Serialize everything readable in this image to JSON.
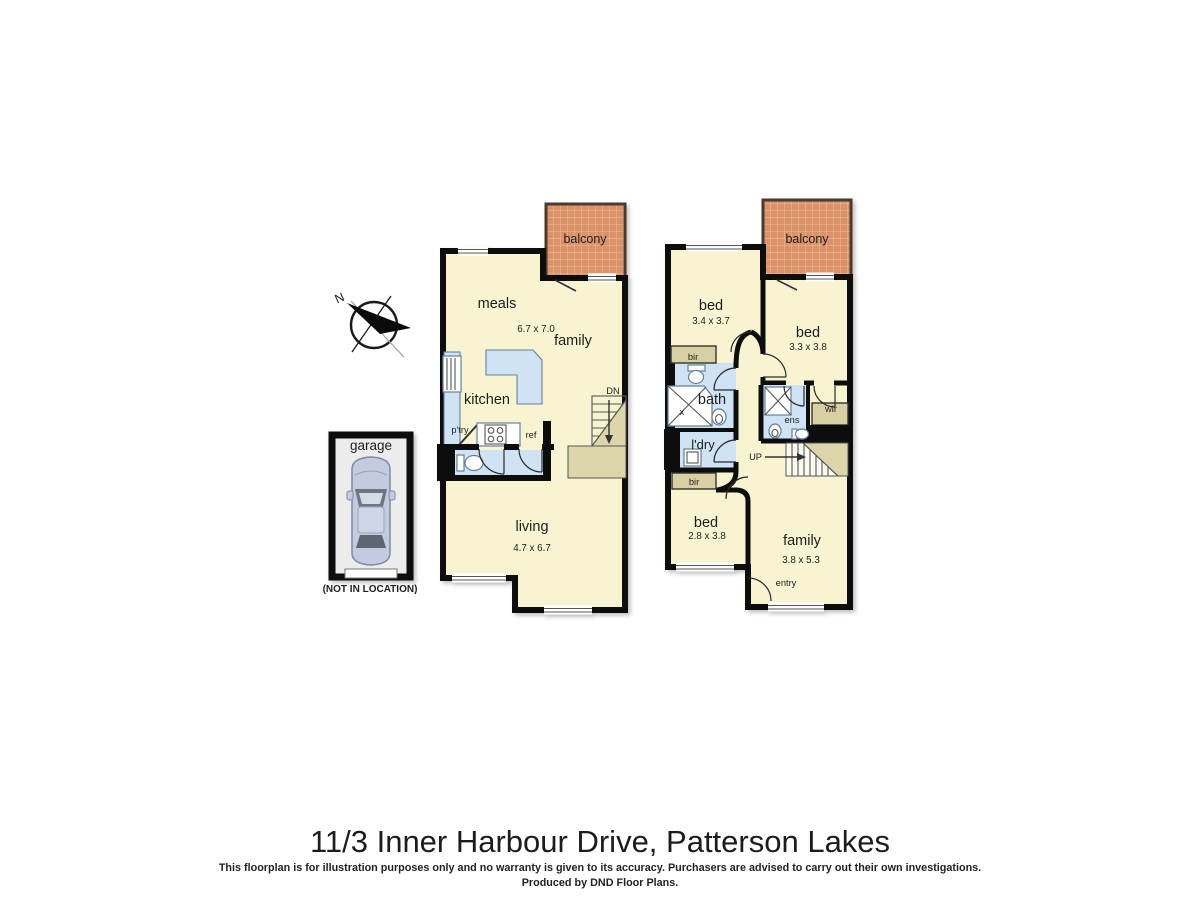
{
  "title": "11/3 Inner Harbour Drive, Patterson Lakes",
  "disclaimer": "This floorplan is for illustration purposes only and no warranty is given to its accuracy. Purchasers are advised to carry out their own investigations.",
  "produced_by": "Produced by DND Floor Plans.",
  "compass": {
    "north": "N"
  },
  "garage": {
    "label": "garage",
    "note": "(NOT IN LOCATION)"
  },
  "left_plan": {
    "balcony": "balcony",
    "meals": "meals",
    "family": {
      "label": "family",
      "dims": "6.7 x 7.0"
    },
    "kitchen": "kitchen",
    "pantry": "p'try",
    "fridge": "ref",
    "living": {
      "label": "living",
      "dims": "4.7 x 6.7"
    },
    "stair": "DN"
  },
  "right_plan": {
    "balcony": "balcony",
    "bed1": {
      "label": "bed",
      "dims": "3.4 x 3.7"
    },
    "bed2": {
      "label": "bed",
      "dims": "3.3 x 3.8"
    },
    "bed3": {
      "label": "bed",
      "dims": "2.8 x 3.8"
    },
    "family": {
      "label": "family",
      "dims": "3.8 x 5.3"
    },
    "bath": {
      "label": "bath",
      "shower": "x"
    },
    "laundry": "l'dry",
    "bir_top": "bir",
    "bir_bottom": "bir",
    "ens": "ens",
    "wir": "wir",
    "entry": "entry",
    "stair": "UP"
  },
  "colors": {
    "floor": "#f8f4d2",
    "balcony": "#db9267",
    "fixture_blue": "#cfe3f4",
    "robe_tan": "#d8d0a2",
    "wall": "#111111"
  }
}
